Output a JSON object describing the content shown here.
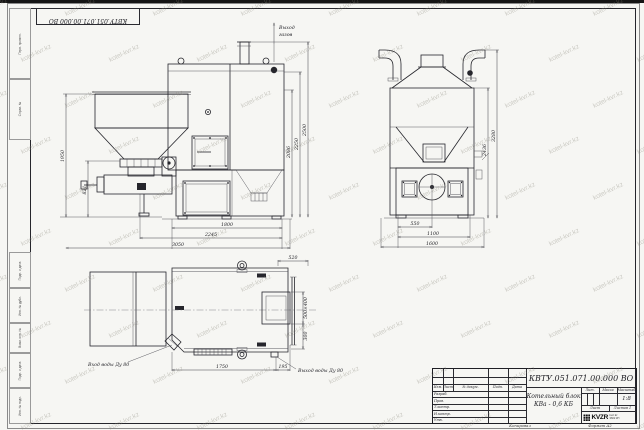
{
  "sheet": {
    "stamp_top_left": "КВТУ.051.071.00.000 ВО",
    "kopiroval": "Копировал",
    "format_label": "Формат А2"
  },
  "watermark": {
    "text": "kotel-kvr.kz"
  },
  "margin_labels": {
    "m1": "Перв. примен.",
    "m2": "Справ. №",
    "m3": "Подп. и дата",
    "m4": "Инв. № дубл.",
    "m5": "Взам. инв. №",
    "m6": "Подп. и дата",
    "m7": "Инв. № подл."
  },
  "annotations": {
    "gas_line1": "Выход",
    "gas_line2": "газов",
    "water_in": "Вход воды Ду 80",
    "water_out": "Выход воды Ду 80"
  },
  "views": {
    "front": {
      "dims": {
        "h_hopper": "1950",
        "h_burner": "821",
        "w_body": "1800",
        "w_mid": "2245",
        "w_total": "3050",
        "h_door": "2086",
        "h_mid": "2250",
        "h_total": "2500"
      }
    },
    "side": {
      "dims": {
        "w_fan": "550",
        "w_body": "1100",
        "w_total": "1600",
        "h_body": "2436",
        "h_total": "3280"
      }
    },
    "plan": {
      "dims": {
        "top": "520",
        "window": "500×400",
        "offset": "300",
        "length": "1750",
        "stub": "195"
      }
    }
  },
  "title_block": {
    "doc_number": "КВТУ.051.071.00.000 ВО",
    "product_name_line1": "Котельный блок",
    "product_name_line2": "КВа - 0,6 КБ",
    "cols": {
      "izm": "Изм.",
      "list": "Лист",
      "docum": "№ докум.",
      "podp": "Подп.",
      "data": "Дата"
    },
    "rows": {
      "razrab": "Разраб.",
      "prov": "Пров.",
      "tkontr": "Т.контр.",
      "nkontr": "Н.контр.",
      "utv": "Утв."
    },
    "lit_label": "Лит.",
    "mass_label": "Масса",
    "scale_label": "Масштаб",
    "scale_value": "1:8",
    "sheet_label": "Лист",
    "sheets_label": "Листов",
    "sheets_value": "1",
    "logo_text": "KVZR",
    "logo_sub1": "kvzr.kz",
    "logo_sub2": "3602 КП"
  }
}
